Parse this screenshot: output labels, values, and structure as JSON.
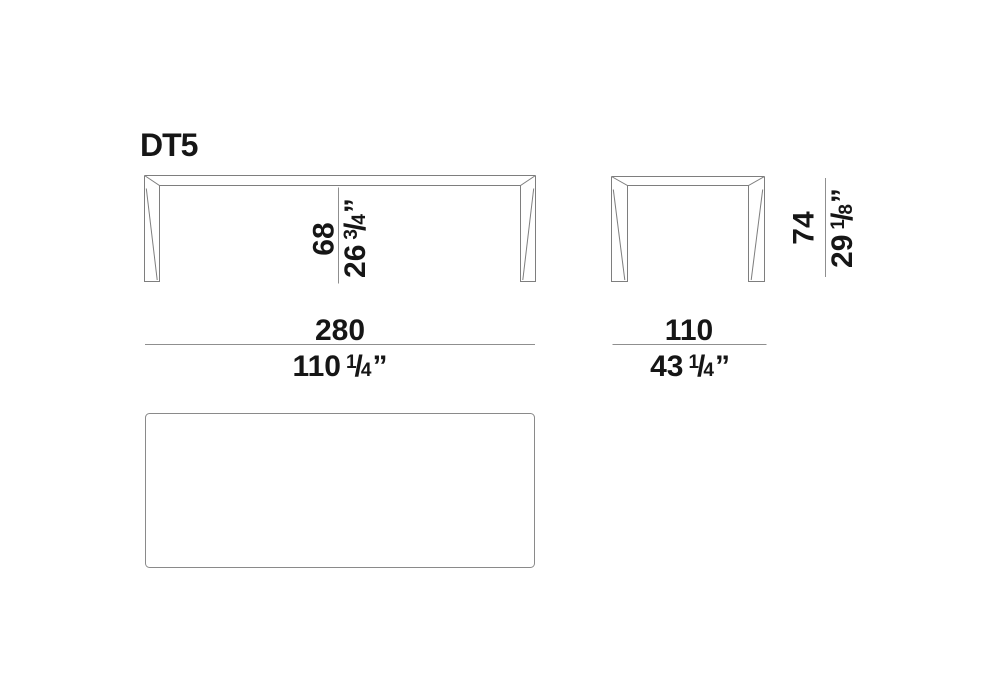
{
  "title": "DT5",
  "colors": {
    "page_background": "#ffffff",
    "text": "#161616",
    "furniture_line": "#7e7e7e",
    "dimension_line": "#8f8f8f",
    "top_view_line": "#8a8a8a"
  },
  "symbols": {
    "fraction_slash": "/",
    "inch_mark": "”"
  },
  "dimensions": {
    "width": {
      "metric": "280",
      "imperial": {
        "whole": "110",
        "num": "1",
        "den": "4"
      }
    },
    "depth": {
      "metric": "110",
      "imperial": {
        "whole": "43",
        "num": "1",
        "den": "4"
      }
    },
    "clearance": {
      "metric": "68",
      "imperial": {
        "whole": "26",
        "num": "3",
        "den": "4"
      }
    },
    "height": {
      "metric": "74",
      "imperial": {
        "whole": "29",
        "num": "1",
        "den": "8"
      }
    }
  }
}
